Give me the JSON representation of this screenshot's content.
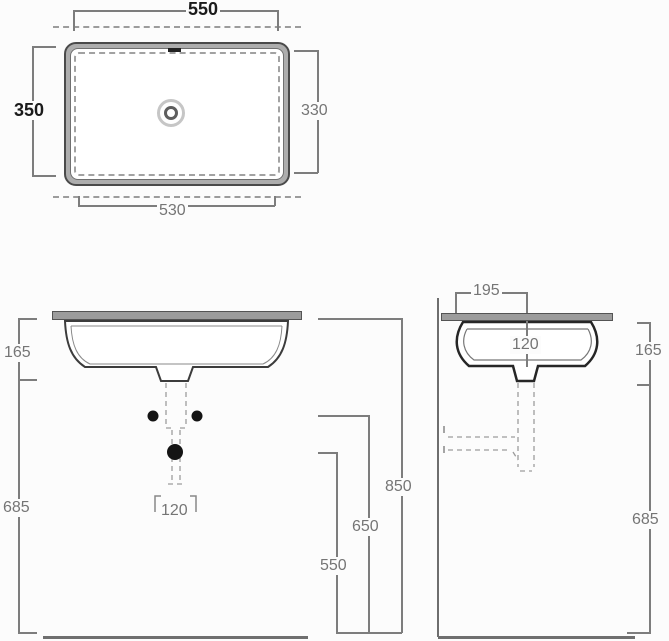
{
  "plan_view": {
    "overall_width": "550",
    "overall_depth": "350",
    "cutout_depth": "330",
    "cutout_width": "530"
  },
  "front_view": {
    "basin_depth": "165",
    "waste_height": "685",
    "worktop_height": "850",
    "fixing_height": "650",
    "trap_height": "550",
    "fixing_spacing": "120"
  },
  "side_view": {
    "waste_offset": "195",
    "waste_drop": "120",
    "basin_depth": "165",
    "waste_height": "685"
  },
  "colors": {
    "line": "#7d7d7d",
    "label": "#757575",
    "label-dark": "#1b1b1b",
    "outline": "#3c3c3c",
    "slab": "#9c9c9c",
    "floor": "#6f6f6f",
    "dash": "#9c9c9c",
    "bg": "#fcfcfc"
  }
}
